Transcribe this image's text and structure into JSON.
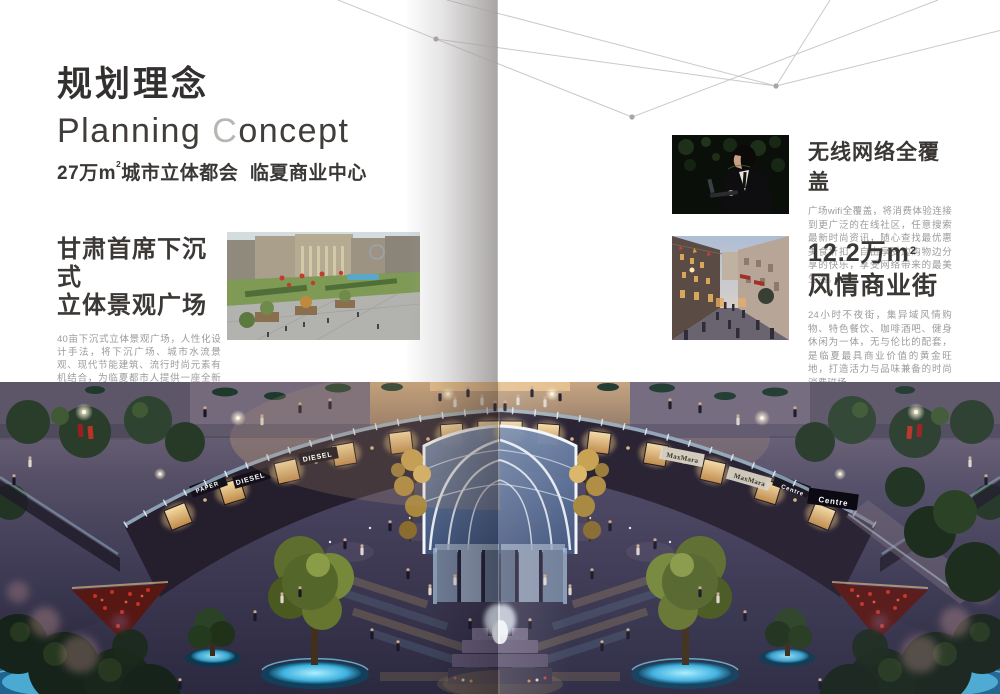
{
  "left": {
    "title_cn": "规划理念",
    "title_en_1": "Planning ",
    "title_en_accent": "C",
    "title_en_2": "oncept",
    "subtitle_pre": "27万m",
    "subtitle_sup": "2",
    "subtitle_post": "城市立体都会  临夏商业中心",
    "section": {
      "heading_line1": "甘肃首席下沉式",
      "heading_line2": "立体景观广场",
      "body": "40亩下沉式立体景观广场，人性化设计手法，将下沉广场、城市水流景观、现代节能建筑、流行时尚元素有机结合，为临夏都市人提供一座全新生活方式的休闲天地。"
    }
  },
  "right": {
    "wifi": {
      "heading": "无线网络全覆盖",
      "body": "广场wifi全覆盖，将消费体验连接到更广泛的在线社区，任意搜索最新时尚资讯，随心查找最优惠美食折扣，自由享受边购物边分享的快乐，享受网络带来的最美生活。"
    },
    "street": {
      "heading_pre": "12.2万m",
      "heading_sup": "2",
      "heading_line2": "风情商业街",
      "body": "24小时不夜街，集异域风情购物、特色餐饮、咖啡酒吧、健身休闲为一体，无与伦比的配套，是临夏最具商业价值的黄金旺地，打造活力与品味兼备的时尚消费磁场。"
    }
  },
  "photo": {
    "signs": {
      "paper": "PAPER",
      "diesel_a": "DIESEL",
      "diesel_b": "DIESEL",
      "maxmara_a": "MaxMara",
      "maxmara_b": "MaxMara",
      "centre_a": "Centre",
      "centre_b": "Centre"
    }
  },
  "colors": {
    "heading_dark": "#3a3632",
    "accent_gray": "#b9b6b2",
    "body_gray": "#9b9b9b"
  }
}
